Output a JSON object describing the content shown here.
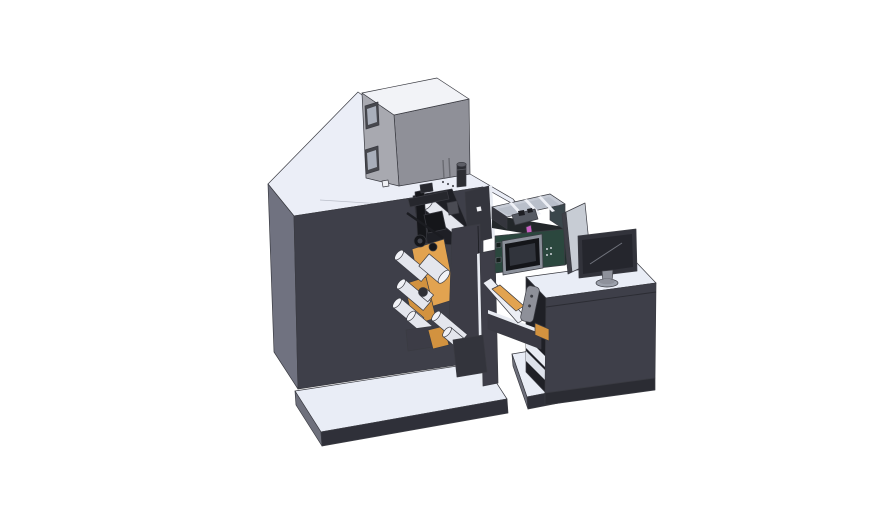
{
  "scene": {
    "type": "3d-cad-render",
    "background": "#ffffff"
  },
  "colors": {
    "top_face": "#ebeef7",
    "body_front": "#3e3f49",
    "body_left": "#707280",
    "platform_top": "#e9edf6",
    "platform_front": "#2f3039",
    "platform_side": "#6e707c",
    "cabinet_top": "#f2f3f7",
    "cabinet_left": "#a8a9b0",
    "cabinet_right": "#8f9098",
    "window_frame": "#46474d",
    "window_glass": "#a9afbb",
    "cabinet_slot": "#6a6b72",
    "vent_body": "#2c2d33",
    "vent_cap": "#5d5e66",
    "notch": "#1e1f25",
    "housing": "#34353d",
    "sliver": "#e8ebf2",
    "orange": "#e2a350",
    "orange_dark": "#d2923f",
    "roller_body": "#e4e6ed",
    "roller_cap": "#f1f2f7",
    "roller_dark": "#2f3036",
    "mech_dark": "#15161a",
    "mech_mid": "#26272d",
    "mech_light": "#4a4b53",
    "mech_inner": "#41434b",
    "mech_rod": "#1b1c21",
    "plate": "#3c3c46",
    "bracket": "#33343c",
    "column": "#3e3e48",
    "beam": "#3a3a44",
    "wedge_white": "#eceef4",
    "handle": "#8e9099",
    "handle_dot": "#3c3d44",
    "desk_top": "#e9edf6",
    "desk_front": "#3e3f49",
    "desk_base": "#2b2c33",
    "desk_interior": "#1f2026",
    "shelf": "#e9ecf3",
    "floor": "#dde1ea",
    "tray_wall_outer": "#3a464b",
    "tray_rim": "#c6cbd5",
    "tray_floor": "#b9bfca",
    "tray_rib": "#eef0f6",
    "tray_mech": "#565a63",
    "tray_bit": "#1e1f24",
    "tray_shadow": "#23272a",
    "pink": "#c95fc2",
    "teal": "#2b473e",
    "teal_edge": "#1c2f2a",
    "screen_frame": "#8a8f99",
    "screen_bezel": "#141519",
    "screen_inner": "#31343c",
    "teal_dot": "#cfd3da",
    "teal_port": "#15201c",
    "panel_face": "#c7ccd4",
    "panel_edge": "#3f4048",
    "monitor_bezel": "#32333b",
    "monitor_screen": "#25262d",
    "monitor_line": "#70737c",
    "stand": "#8e919b",
    "stand_base": "#9ba0ab",
    "seam": "#b9bdc8",
    "dot": "#53545c",
    "highlight_chip": "#f0f1f5"
  },
  "components": [
    "main-machine-body",
    "electrical-cabinet",
    "base-platform",
    "unwind-roller-group",
    "media-roll-orange",
    "print-head-mechanism",
    "front-mounting-plate",
    "support-column",
    "transfer-beam",
    "handle-tool",
    "parts-tray",
    "control-unit",
    "touchscreen",
    "operator-desk",
    "desk-base-platform",
    "divider-panel",
    "monitor"
  ]
}
